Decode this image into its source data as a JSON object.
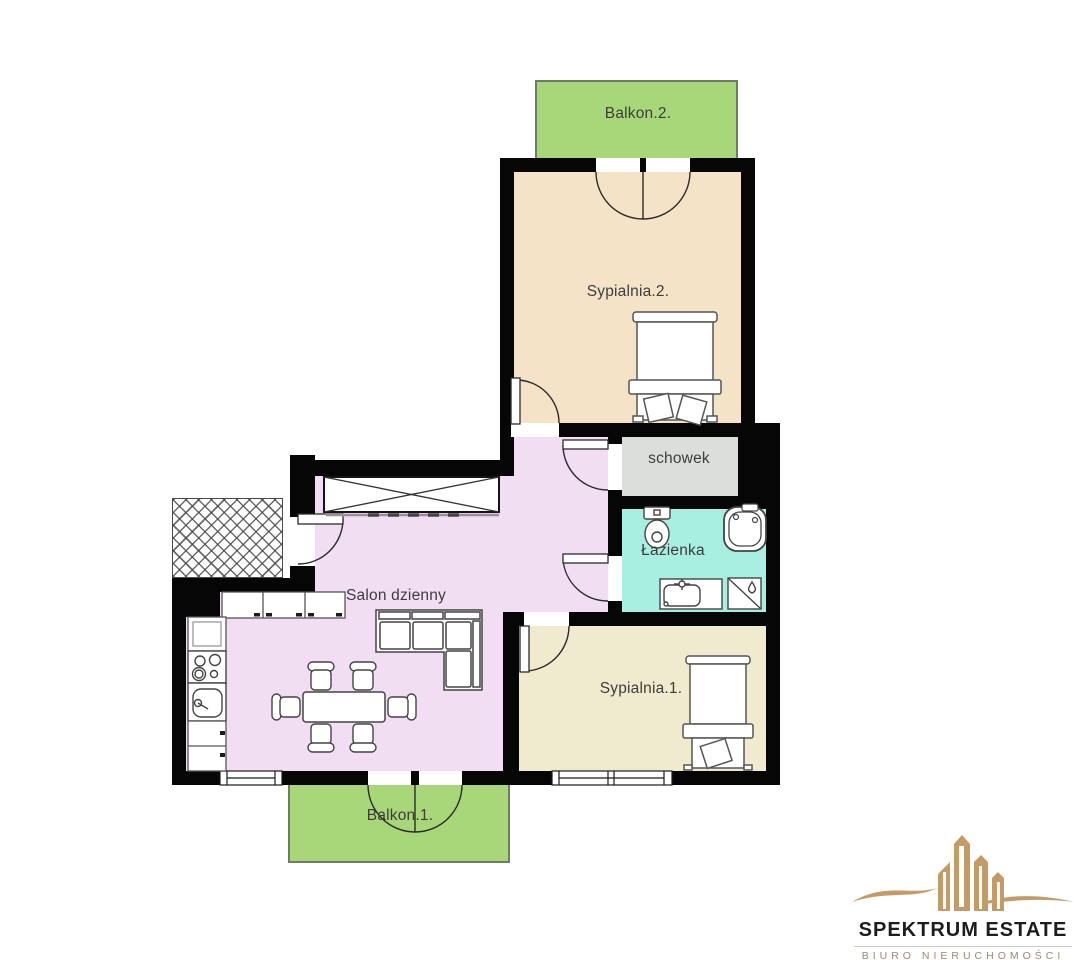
{
  "plan": {
    "type": "apartment-floor-plan",
    "rooms": [
      {
        "name": "balkon-2",
        "label": "Balkon.2.",
        "color": "#a7d778"
      },
      {
        "name": "sypialnia-2",
        "label": "Sypialnia.2.",
        "color": "#f5e3c8"
      },
      {
        "name": "schowek",
        "label": "schowek",
        "color": "#dbdedb"
      },
      {
        "name": "lazienka",
        "label": "Łazienka",
        "color": "#a9efe1"
      },
      {
        "name": "salon-dzienny",
        "label": "Salon dzienny",
        "color": "#f2def2"
      },
      {
        "name": "sypialnia-1",
        "label": "Sypialnia.1.",
        "color": "#f0ebce"
      },
      {
        "name": "balkon-1",
        "label": "Balkon.1.",
        "color": "#a7d778"
      }
    ],
    "wall_color": "#060606"
  },
  "logo": {
    "title": "SPEKTRUM ESTATE",
    "subtitle": "BIURO NIERUCHOMOŚCI",
    "accent_color": "#c49b67"
  }
}
